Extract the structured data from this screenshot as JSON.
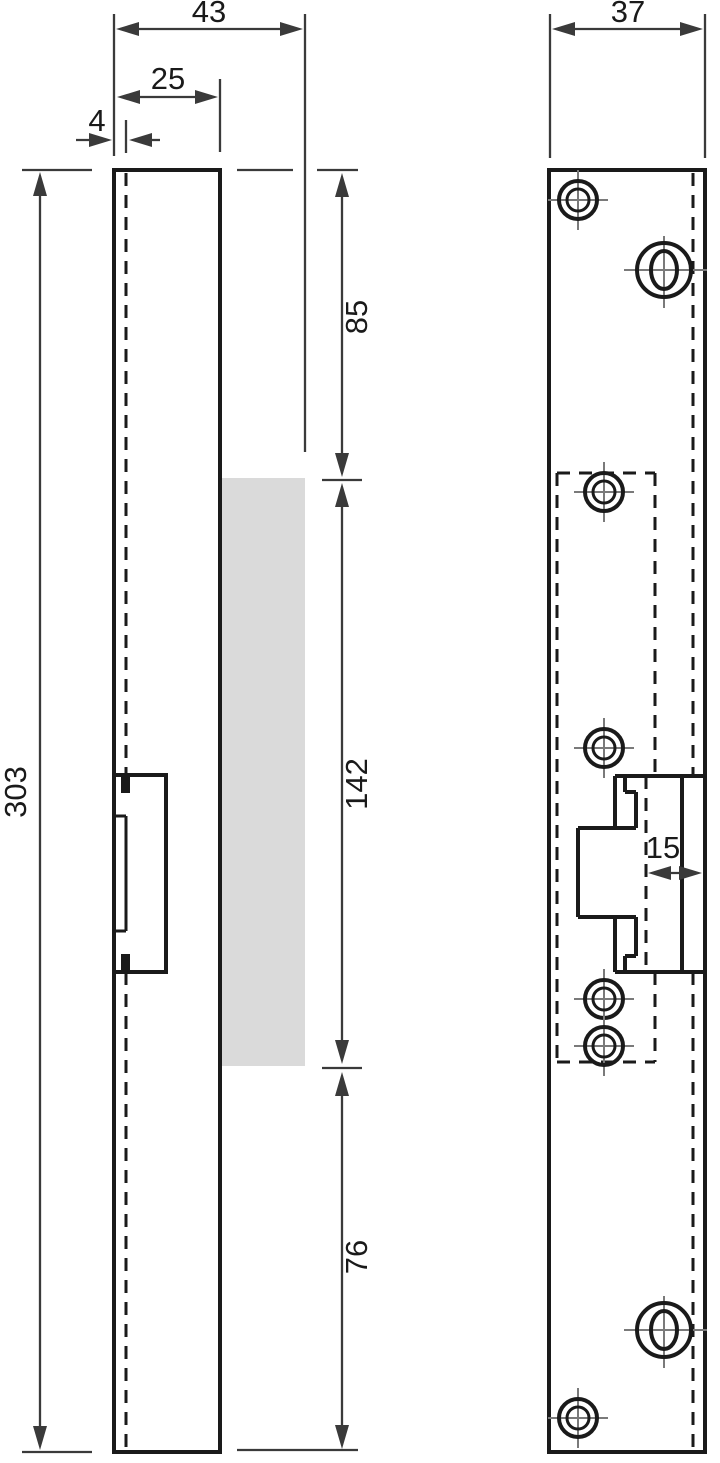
{
  "drawing": {
    "kind": "technical-orthographic-drawing",
    "dimensions": {
      "total_depth": "43",
      "body_depth": "25",
      "faceplate_thickness": "4",
      "total_height": "303",
      "top_section": "85",
      "strike_section": "142",
      "bottom_section": "76",
      "faceplate_width": "37",
      "latch_inset": "15"
    }
  },
  "colors": {
    "line": "#1a1a1a",
    "thin": "#3a3a3a",
    "crosshair": "#7a7a7a",
    "highlight": "#dadada",
    "background": "#ffffff"
  }
}
